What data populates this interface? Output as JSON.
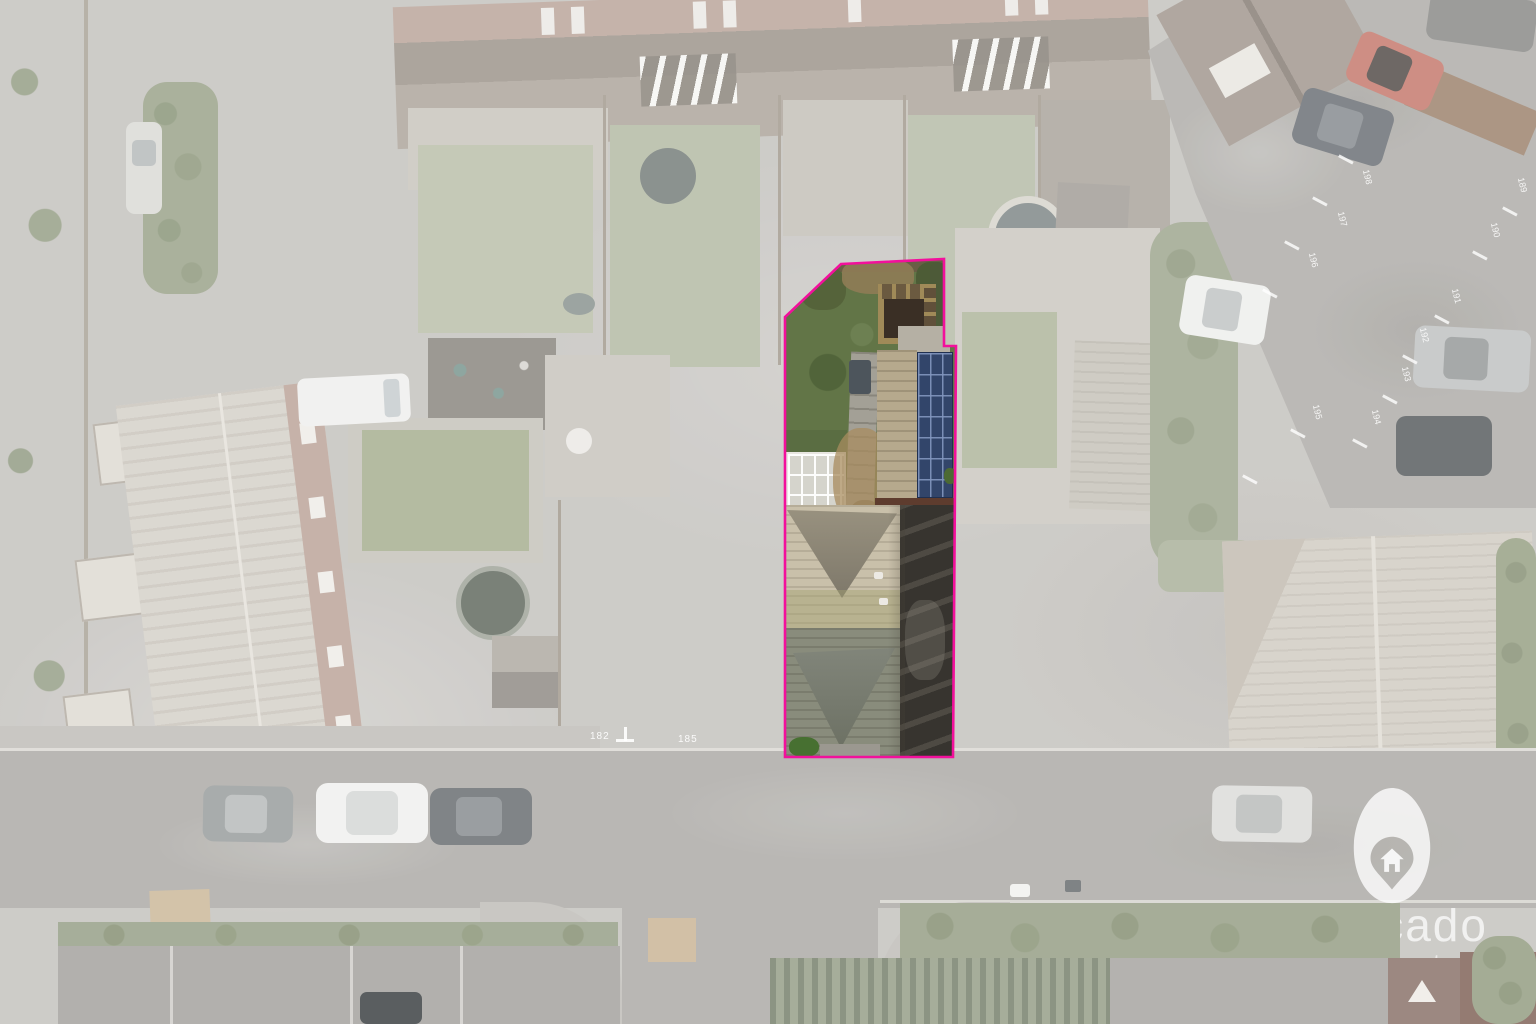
{
  "image": {
    "type": "aerial-drone-photograph",
    "description": "Overhead view of a residential street; one property plot highlighted, surroundings faded",
    "width_px": 1536,
    "height_px": 1024
  },
  "highlight": {
    "name": "property-boundary",
    "outline_color": "#f2109c"
  },
  "watermark": {
    "brand": "avocado",
    "subtitle": "property",
    "icon": "avocado-pin-house-icon",
    "color": "#ffffff"
  },
  "road_markings": {
    "pavement_numbers": [
      "182",
      "185"
    ]
  },
  "parking": {
    "bay_numbers": [
      "198",
      "197",
      "196",
      "195",
      "194",
      "193",
      "192",
      "191",
      "190",
      "189"
    ]
  }
}
